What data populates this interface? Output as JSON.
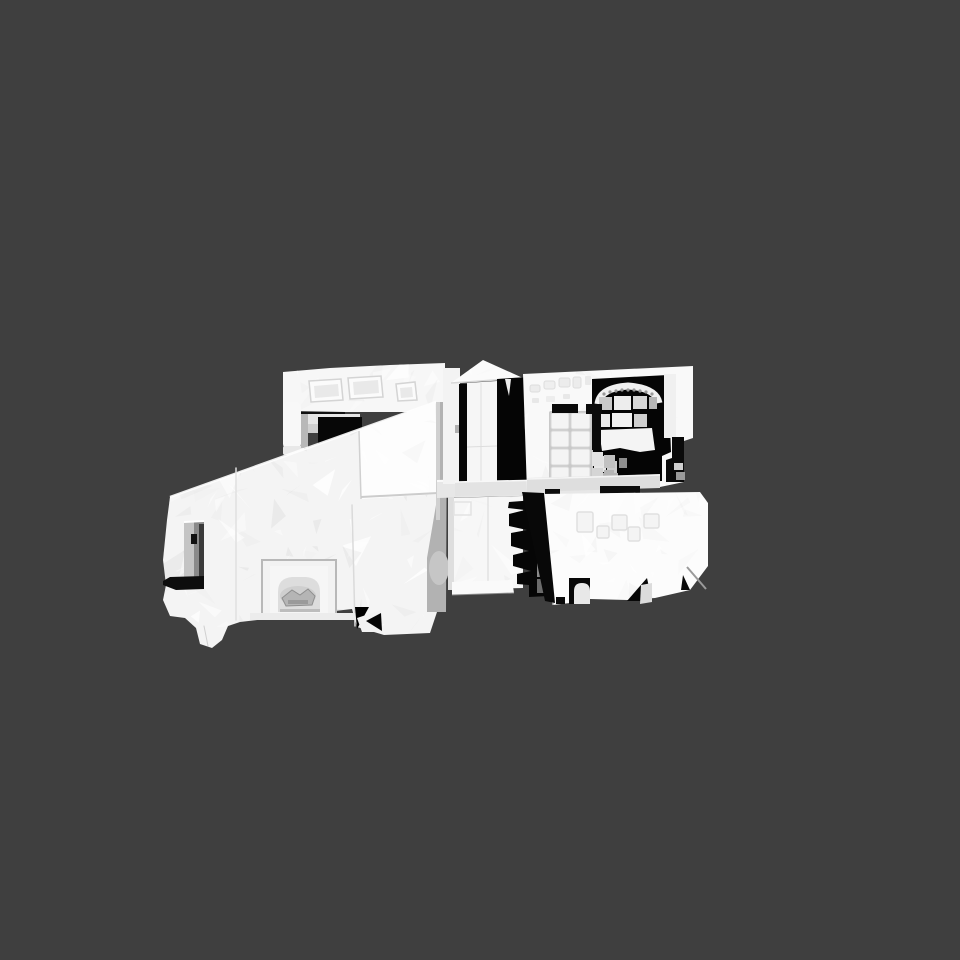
{
  "scene": {
    "description": "Untextured white 3D photogrammetry mesh of a house shown in a 3D model viewer viewport on a flat dark gray background; no menus, toolbars or text are visible",
    "viewport": {
      "width": 960,
      "height": 960
    },
    "background_color": "#3f3f3f",
    "model": {
      "name": "house-scan-mesh",
      "surface_color": "#f4f4f4",
      "highlight_color": "#ffffff",
      "shadow_color": "#050505",
      "mid_gray_color": "#b2b2b2",
      "parts": [
        "left wing with faceted roof plane",
        "recessed window opening with dark sill",
        "garage niche with scanned car object",
        "roof slab with three embossed skylights",
        "gabled porch with pediment",
        "kitchen room with cabinet grid and arched shelf alcove",
        "middle rooms with shadow gap and stair steps",
        "right roof slab with faint skylight outlines and support pillars"
      ]
    }
  }
}
